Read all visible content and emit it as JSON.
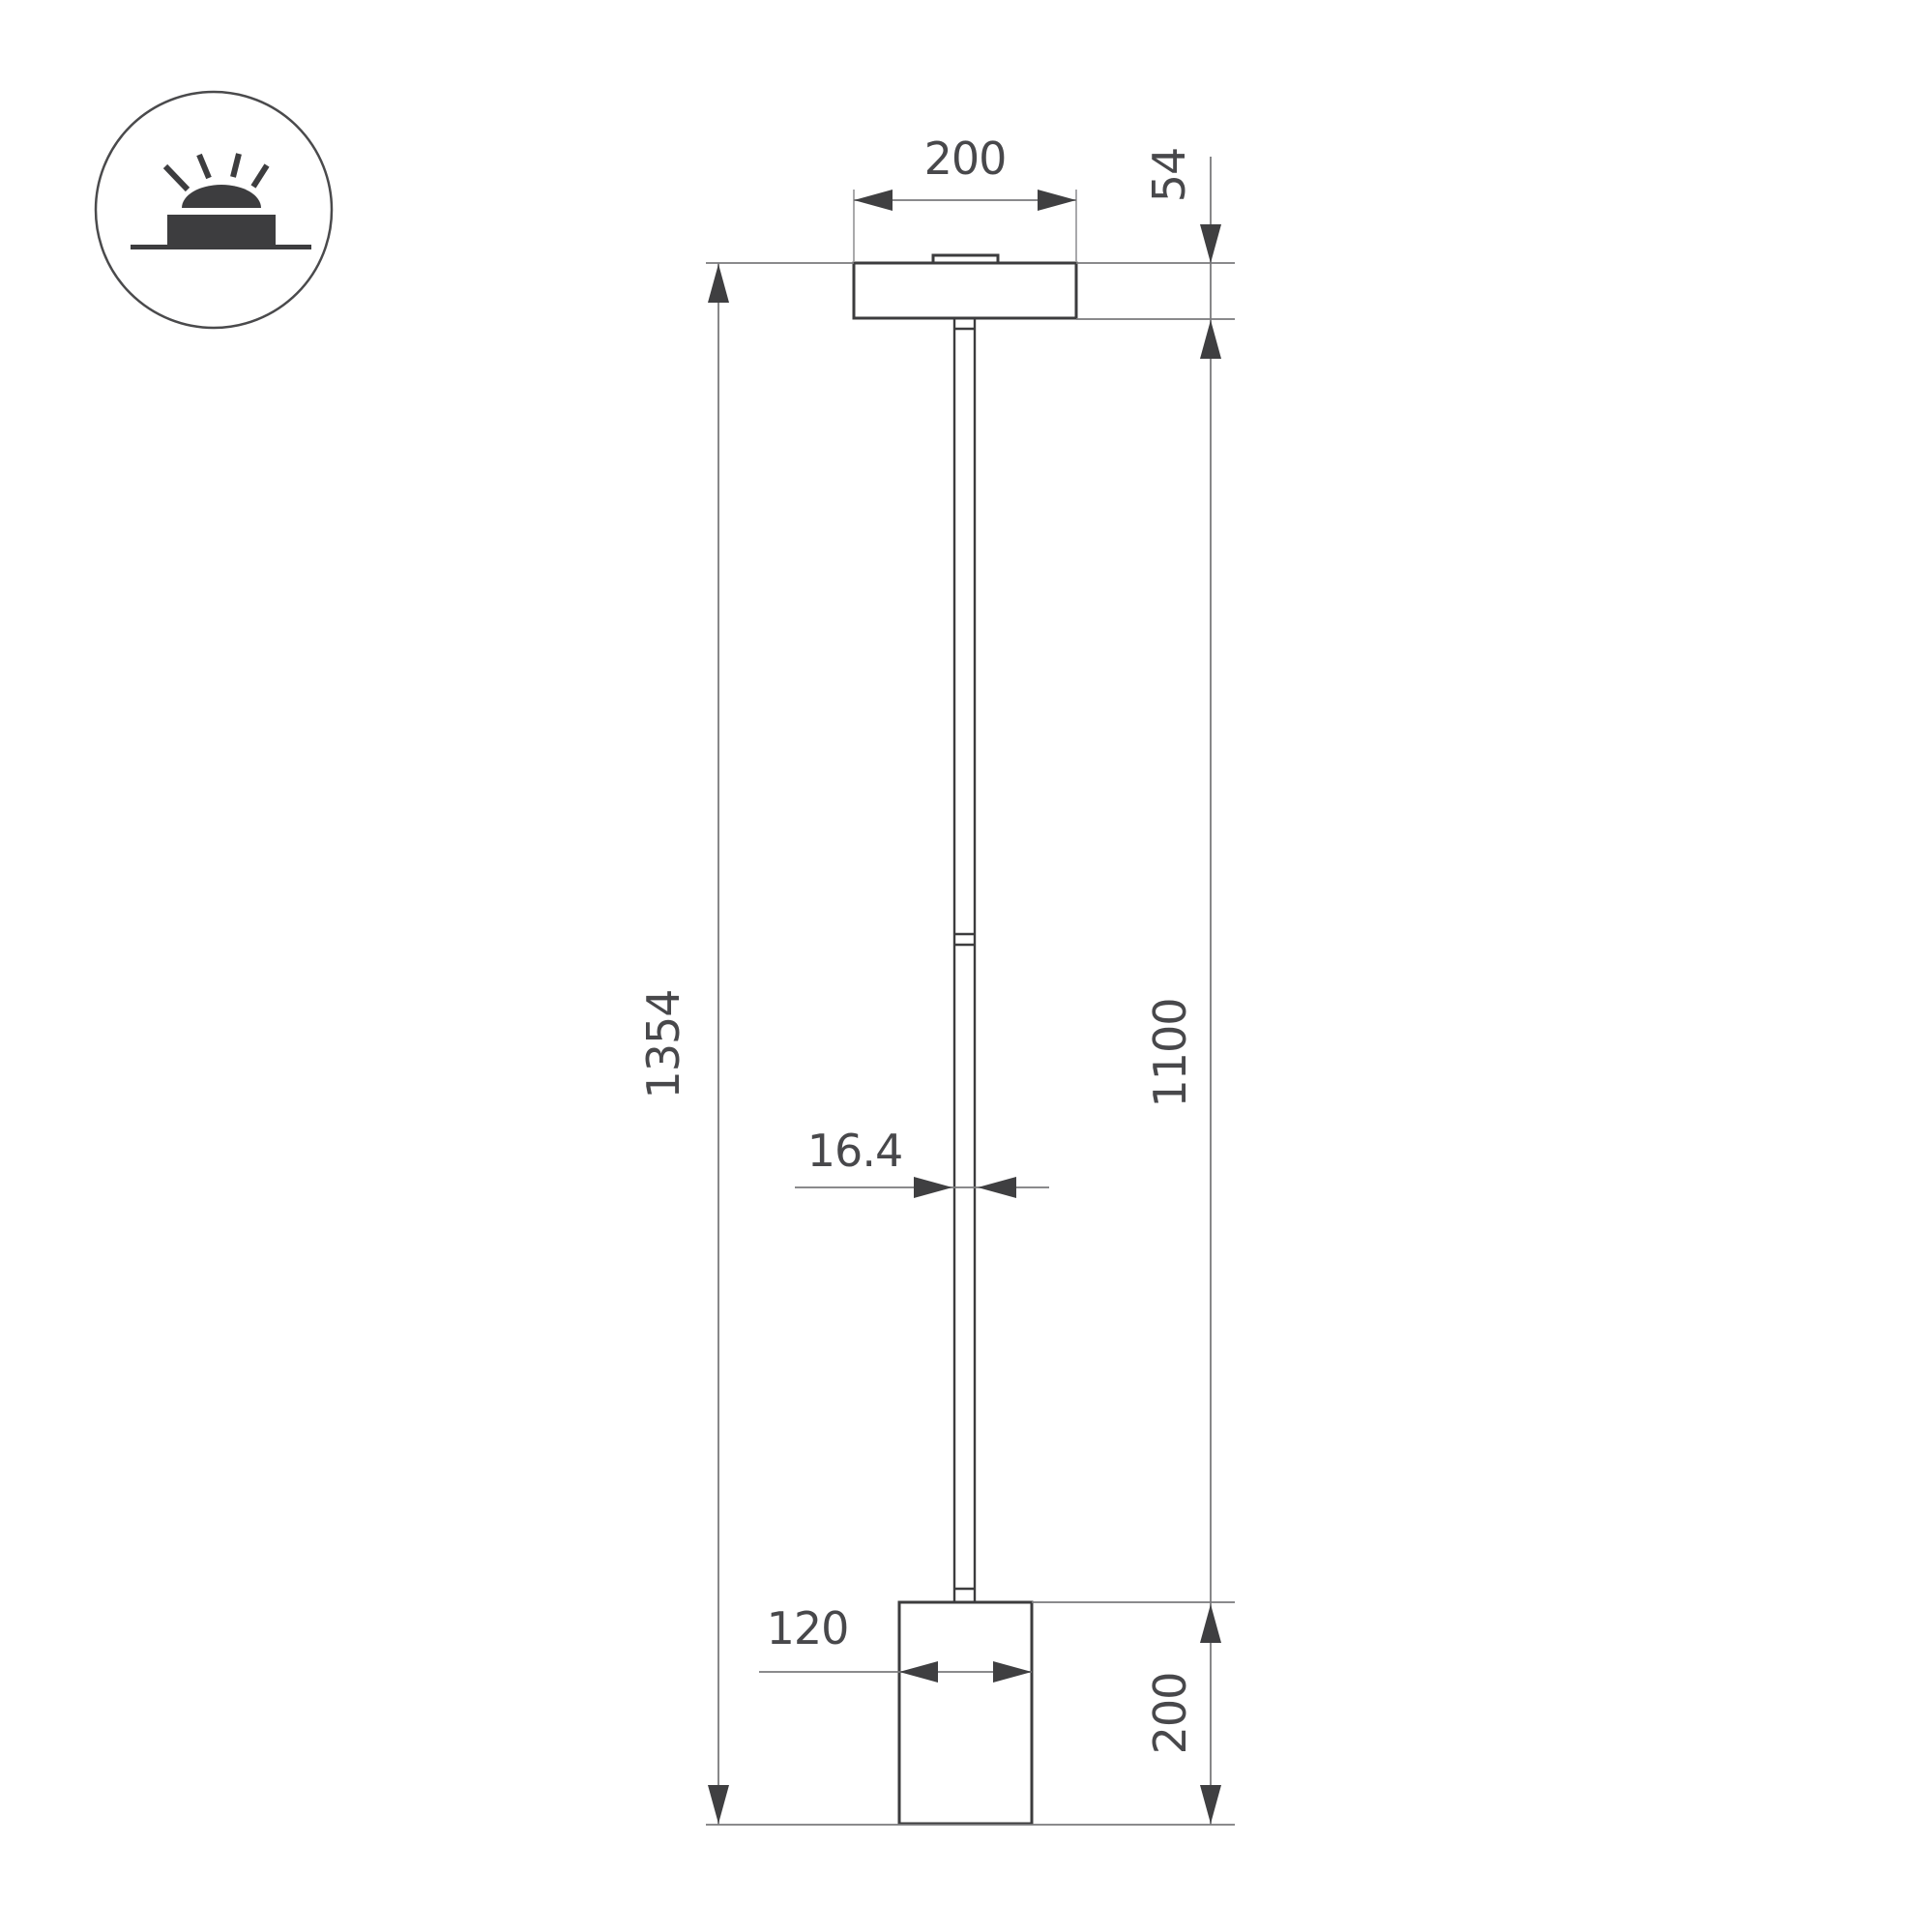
{
  "icon": {
    "name": "surface-mounted-luminaire-icon",
    "description": "circle badge with glowing surface-mounted lamp pictogram"
  },
  "dimensions": {
    "canopy_width": "200",
    "canopy_height": "54",
    "total_height": "1354",
    "rod_height": "1100",
    "rod_diameter": "16.4",
    "base_diameter": "120",
    "base_height": "200"
  },
  "colors": {
    "outline": "#3c3c3e",
    "dimension_line": "#7a7a7c",
    "extension_line_light": "#a9a9ab",
    "arrow": "#3f3f41",
    "text": "#48484b",
    "background": "#ffffff"
  }
}
